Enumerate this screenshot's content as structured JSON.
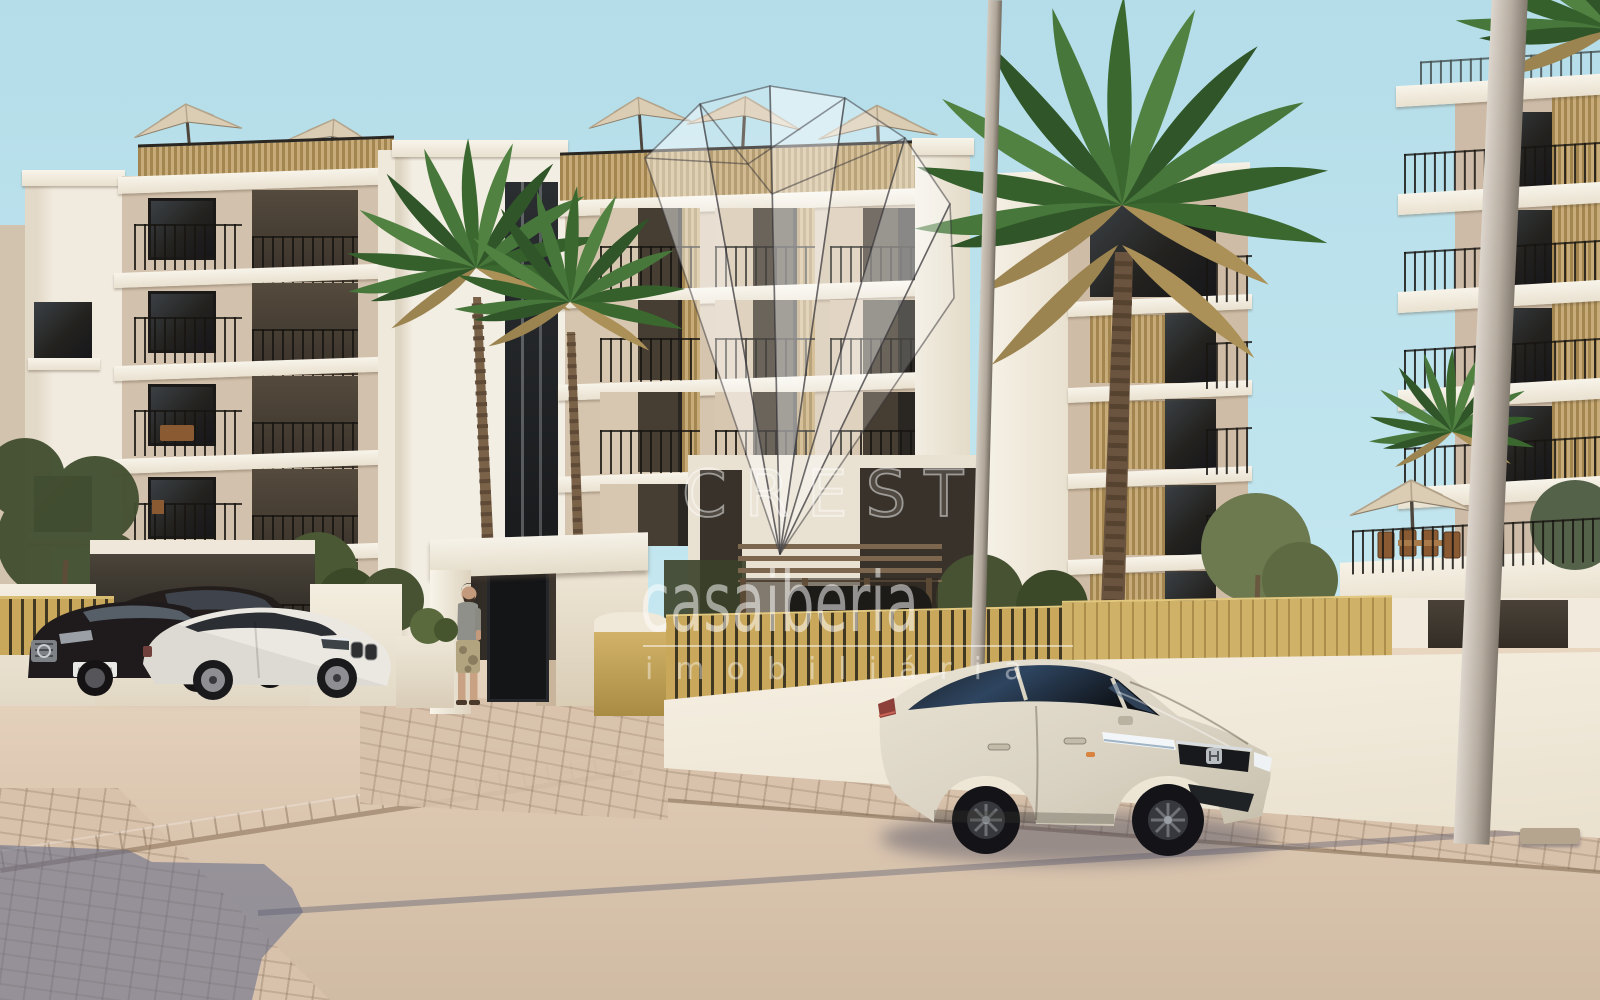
{
  "watermark": {
    "brand_text": "CREST",
    "brand_logo": "crystal-fan-gem",
    "name_text": "casaiberia",
    "tagline_text": "imobiliária"
  },
  "scene": {
    "type": "3d-architectural-render",
    "description": "New-build beige apartment complex with palm trees, parked cars, street lamp poles and paved street in warm evening light",
    "sky_color": "#bfe3ec",
    "facade_sunlit": "#d8c7b2",
    "facade_shaded": "#c7b49d",
    "slab_white": "#f5f0e5",
    "balcony_recess": "#453c31",
    "railing_black": "#1c1a17",
    "wood_slat_gold": "#c2a464",
    "fence_gold": "#c9a85c",
    "road": "#dcc7b1",
    "paver": "#d8c2ab",
    "shadow_blue": "#76809c",
    "palm_green": "#3f7034",
    "palm_dead_frond": "#ab9157",
    "grass": "#7d8a4c",
    "buildings": [
      "left-apartment-block",
      "central-apartment-block",
      "middle-apartment-block",
      "right-apartment-block"
    ],
    "vehicles": [
      "dark-mercedes-sedan",
      "dark-bmw-sedan",
      "white-bmw-coupe",
      "beige-honda-civic-sedan",
      "covered-car-under-pergola"
    ],
    "objects": [
      "rooftop-parasols",
      "palm-trees",
      "entrance-canopy",
      "standing-man",
      "street-lamp-poles",
      "gold-slatted-fence",
      "terrace-dining-set",
      "garden-shrubs"
    ]
  }
}
